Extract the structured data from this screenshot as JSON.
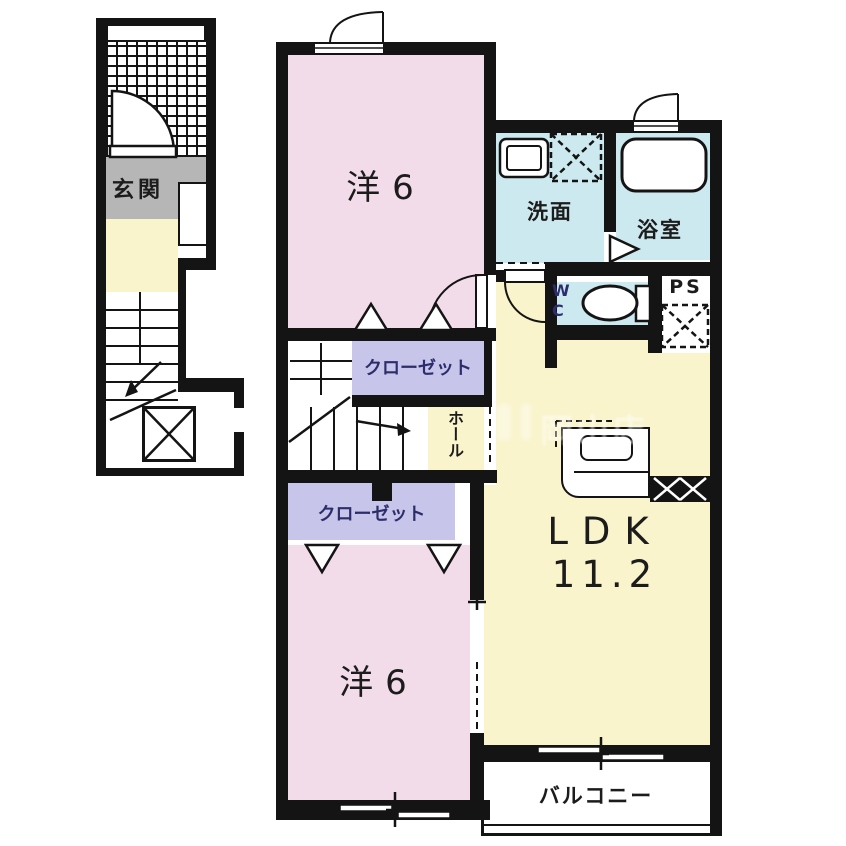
{
  "rooms": {
    "genkan": {
      "label": "玄関"
    },
    "yo6_top": {
      "label": "洋6"
    },
    "senmen": {
      "label": "洗面"
    },
    "yokushitsu": {
      "label": "浴室"
    },
    "wc": {
      "line1": "W",
      "line2": "C"
    },
    "ps": {
      "label": "PS"
    },
    "closet_top": {
      "label": "クローゼット"
    },
    "closet_bottom": {
      "label": "クローゼット"
    },
    "hall": {
      "label": "ホール"
    },
    "ldk": {
      "label": "LDK",
      "size": "11.2"
    },
    "yo6_bottom": {
      "label": "洋6"
    },
    "balcony": {
      "label": "バルコニー"
    }
  },
  "watermark": {
    "text": "岡山店"
  },
  "colors": {
    "wall": "#141414",
    "pink": "#f3dce9",
    "cyan": "#cbe9ef",
    "yellow": "#f9f4cb",
    "lavender": "#c7c5e9",
    "gray": "#b6b6b6",
    "navy": "#2d2d6b",
    "ink": "#1c1c1c",
    "paper": "#ffffff"
  }
}
